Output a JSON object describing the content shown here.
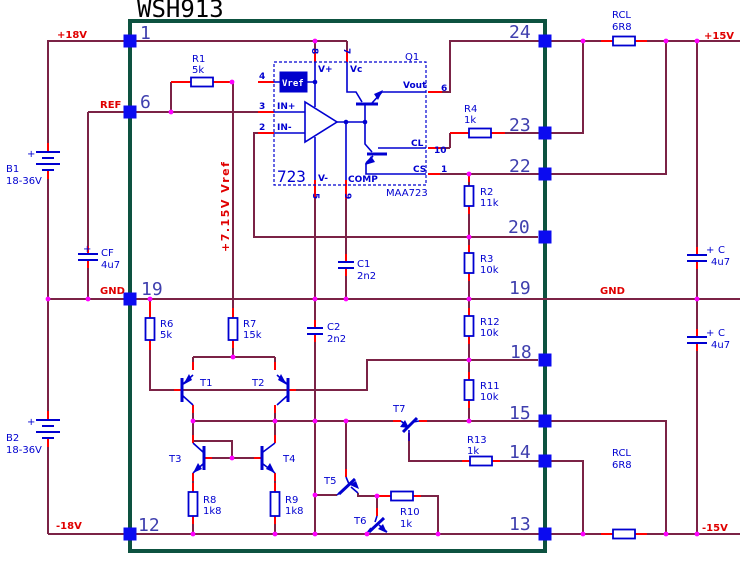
{
  "title": "WSH913",
  "module": {
    "pins_left": [
      "1",
      "6",
      "19",
      "12"
    ],
    "pins_right": [
      "24",
      "23",
      "22",
      "20",
      "19",
      "18",
      "15",
      "14",
      "13"
    ]
  },
  "nets": {
    "p18v": "+18V",
    "ref": "REF",
    "gnd_left": "GND",
    "m18v": "-18V",
    "p15v": "+15V",
    "gnd_right": "GND",
    "m15v": "-15V",
    "vref_rail": "+7.15V Vref"
  },
  "ic723": {
    "designator": "Q1",
    "big_label": "723",
    "part_number": "MAA723",
    "vref_block": "Vref",
    "vplus": "V+",
    "vc": "Vc",
    "vminus": "V-",
    "comp": "COMP",
    "in_plus": "IN+",
    "in_minus": "IN-",
    "vout": "Vout",
    "cl": "CL",
    "cs": "CS",
    "pin8": "8",
    "pin7": "7",
    "pin4": "4",
    "pin3": "3",
    "pin2": "2",
    "pin5": "5",
    "pin9": "9",
    "pin6": "6",
    "pin10": "10",
    "pin1": "1"
  },
  "parts": {
    "r1": {
      "ref": "R1",
      "value": "5k"
    },
    "r2": {
      "ref": "R2",
      "value": "11k"
    },
    "r3": {
      "ref": "R3",
      "value": "10k"
    },
    "r4": {
      "ref": "R4",
      "value": "1k"
    },
    "r6": {
      "ref": "R6",
      "value": "5k"
    },
    "r7": {
      "ref": "R7",
      "value": "15k"
    },
    "r8": {
      "ref": "R8",
      "value": "1k8"
    },
    "r9": {
      "ref": "R9",
      "value": "1k8"
    },
    "r10": {
      "ref": "R10",
      "value": "1k"
    },
    "r11": {
      "ref": "R11",
      "value": "10k"
    },
    "r12": {
      "ref": "R12",
      "value": "10k"
    },
    "r13": {
      "ref": "R13",
      "value": "1k"
    },
    "rcl_top": {
      "ref": "RCL",
      "value": "6R8"
    },
    "rcl_bot": {
      "ref": "RCL",
      "value": "6R8"
    },
    "c1": {
      "ref": "C1",
      "value": "2n2"
    },
    "c2": {
      "ref": "C2",
      "value": "2n2"
    },
    "cf": {
      "ref": "CF",
      "value": "4u7",
      "polarity": "+"
    },
    "c_top": {
      "ref": "C",
      "value": "4u7",
      "polarity": "+"
    },
    "c_bot": {
      "ref": "C",
      "value": "4u7",
      "polarity": "+"
    },
    "b1": {
      "ref": "B1",
      "value": "18-36V",
      "polarity": "+"
    },
    "b2": {
      "ref": "B2",
      "value": "18-36V",
      "polarity": "+"
    },
    "t1": {
      "ref": "T1"
    },
    "t2": {
      "ref": "T2"
    },
    "t3": {
      "ref": "T3"
    },
    "t4": {
      "ref": "T4"
    },
    "t5": {
      "ref": "T5"
    },
    "t6": {
      "ref": "T6"
    },
    "t7": {
      "ref": "T7"
    }
  },
  "colors": {
    "wire": "#7b2346",
    "pin_red": "#ff0000",
    "component_blue": "#0000d0",
    "junction": "#ff00ff",
    "module_border": "#0d5240",
    "pad": "#0b0bf0"
  }
}
